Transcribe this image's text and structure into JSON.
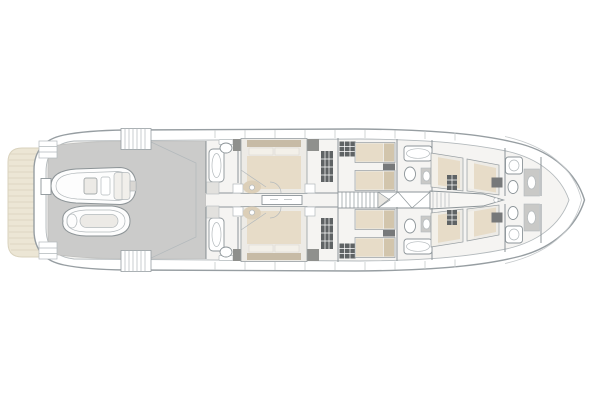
{
  "app": {
    "title": "yacht-lower-deck-floor-plan",
    "background": "#ffffff"
  },
  "colors": {
    "hull_stroke": "#979ea2",
    "inner_stroke": "#b3b9bc",
    "wall": "#8d9599",
    "interior_floor": "#f5f4f2",
    "garage_deck": "#cbcbca",
    "garage_edge": "#bfbfbd",
    "teak": "#ece6d5",
    "teak_line": "#d9d2bd",
    "bed_duvet": "#e7dcc8",
    "bed_headboard": "#c7bba6",
    "bed_pillow": "#f3f0e9",
    "bed_platform": "#edebe6",
    "pillow_tan": "#d2c5ac",
    "locker_dark": "#5f6365",
    "wardrobe_gray": "#8f908d",
    "nightstand_gray": "#77797a",
    "fixture_gray": "#c9c9c7",
    "tile": "#e2e1de",
    "vanity_beige": "#dccfb8",
    "stair_wedge": "#e8e6e1",
    "chine": "#c6cacc",
    "white": "#ffffff"
  },
  "legend": {
    "view": "top-down",
    "bow_direction": "right",
    "areas": [
      {
        "id": "swim-platform",
        "label": "teak swim platform"
      },
      {
        "id": "tender-garage",
        "label": "garage with tender and jet ski"
      },
      {
        "id": "vip-cabin-port",
        "label": "aft double cabin, port"
      },
      {
        "id": "vip-cabin-starboard",
        "label": "aft double cabin, starboard"
      },
      {
        "id": "twin-cabin-port",
        "label": "twin cabin, port"
      },
      {
        "id": "twin-cabin-starboard",
        "label": "twin cabin, starboard"
      },
      {
        "id": "staircase",
        "label": "companionway staircase"
      },
      {
        "id": "forward-cabin-port",
        "label": "forward cabin, port"
      },
      {
        "id": "forward-cabin-starboard",
        "label": "forward cabin, starboard"
      },
      {
        "id": "bow-bathrooms",
        "label": "forward bathrooms"
      }
    ]
  }
}
